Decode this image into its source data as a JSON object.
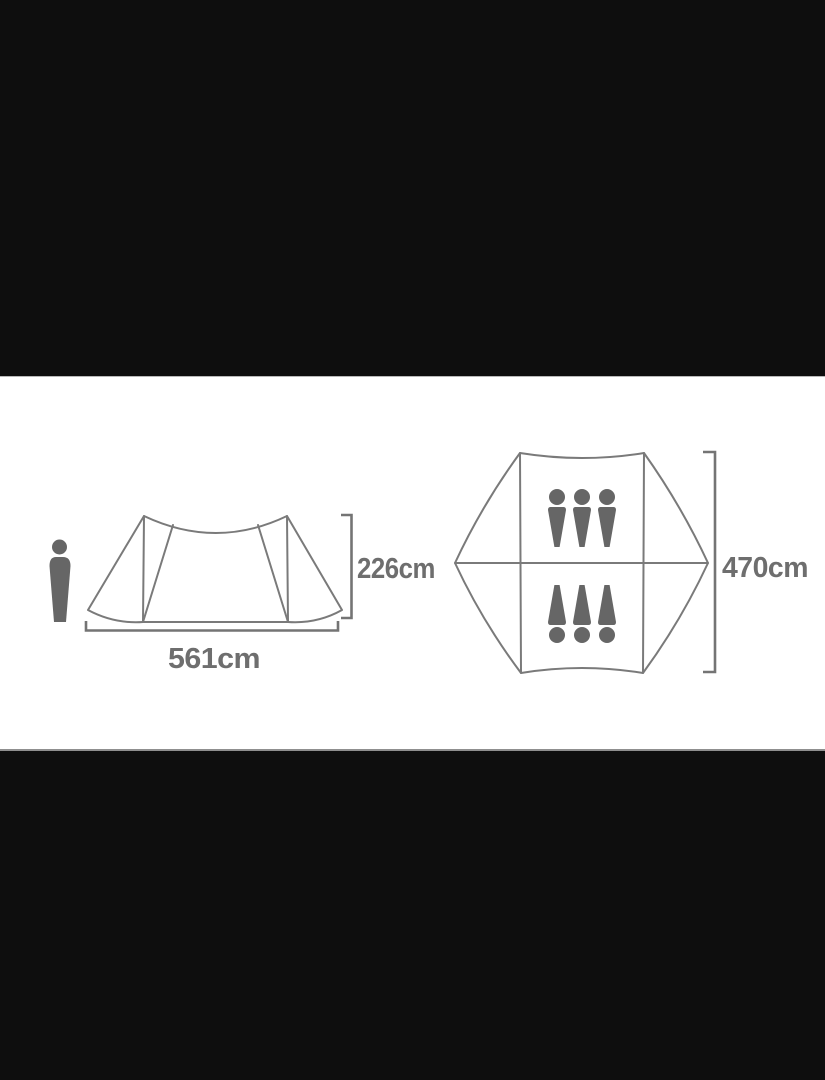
{
  "window": {
    "letterbox_color": "#0e0e0e",
    "canvas_color": "#ffffff"
  },
  "diagram": {
    "side_view": {
      "height_label": "226cm",
      "width_label": "561cm"
    },
    "floor_plan": {
      "length_label": "470cm",
      "person_icons_top_row": 3,
      "person_icons_bottom_row": 3,
      "capacity_persons": 6
    },
    "colors": {
      "outline_gray": "#7a7a7a",
      "floor_fill_gray": "#e3e3e3",
      "icon_gray": "#666666",
      "label_gray": "#6e6e6e"
    },
    "icons": {
      "human_scale_figure": "standing-person-silhouette",
      "occupant": "person-silhouette"
    }
  }
}
